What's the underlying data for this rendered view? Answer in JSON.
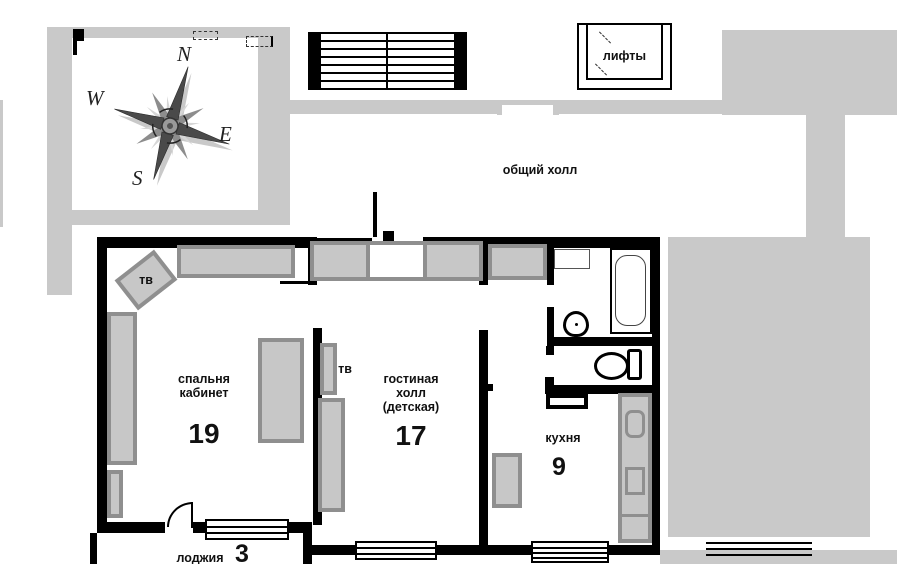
{
  "labels": {
    "common_hall": "общий холл",
    "elevators": "лифты"
  },
  "compass": {
    "north": "N",
    "south": "S",
    "east": "E",
    "west": "W"
  },
  "rooms": {
    "bedroom": {
      "line1": "спальня",
      "line2": "кабинет",
      "area": "19",
      "tv": "тв"
    },
    "living": {
      "line1": "гостиная",
      "line2": "холл",
      "line3": "(детская)",
      "area": "17",
      "tv": "тв"
    },
    "kitchen": {
      "name": "кухня",
      "area": "9"
    },
    "loggia": {
      "name": "лоджия",
      "area": "3"
    }
  },
  "colors": {
    "mask_gray": "#c9c9c9",
    "furniture_fill": "#c7c7c7",
    "furniture_border": "#8f8f8f",
    "wall": "#000000"
  }
}
